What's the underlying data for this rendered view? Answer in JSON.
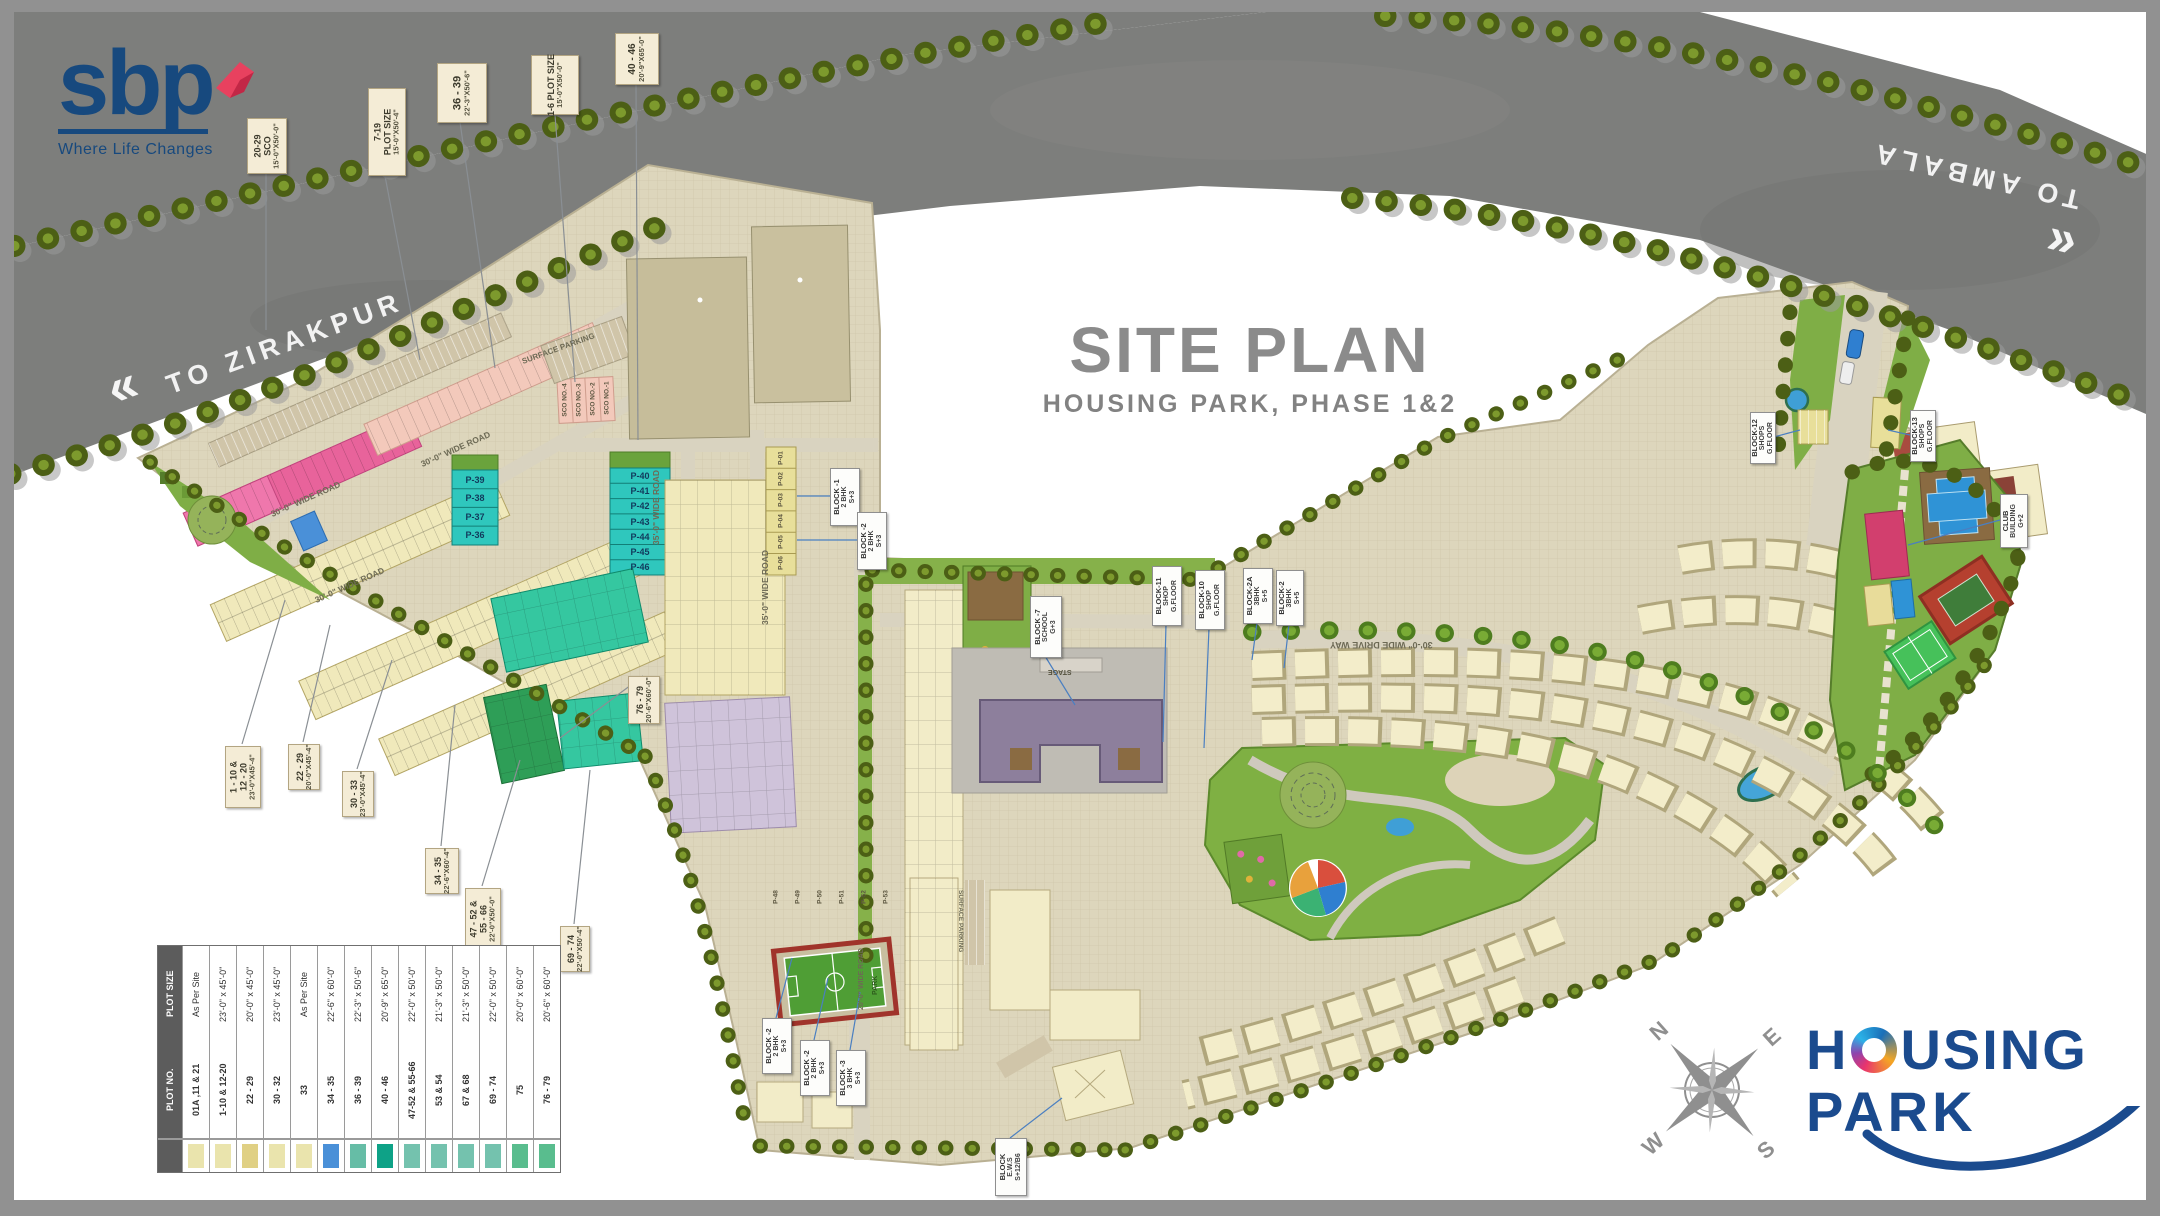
{
  "page": {
    "title": "SITE PLAN",
    "subtitle": "HOUSING PARK, PHASE 1&2"
  },
  "brand": {
    "name": "sbp",
    "tagline": "Where Life Changes"
  },
  "footer_logo": {
    "line1": "HOUSING",
    "line2": "PARK"
  },
  "compass": {
    "n": "N",
    "e": "E",
    "s": "S",
    "w": "W"
  },
  "roads": {
    "to_zirakpur": "TO ZIRAKPUR",
    "to_ambala": "TO AMBALA",
    "chevron_left": "«",
    "chevron_right": "»"
  },
  "map_labels": {
    "surface_parking": "SURFACE PARKING",
    "wide_road_30": "30'-0\" WIDE ROAD",
    "wide_road_35": "35'-0\" WIDE ROAD",
    "wide_road_20": "20'-0\" WIDE ROAD",
    "drive_way": "30'-0\" WIDE DRIVE WAY",
    "stage": "STAGE",
    "park": "PARK"
  },
  "road_callouts": [
    {
      "lines": [
        "20-29",
        "SCO",
        "15'-0\"X50'-0\""
      ]
    },
    {
      "lines": [
        "7-19",
        "PLOT SIZE",
        "15'-0\"X50'-4\""
      ]
    },
    {
      "lines": [
        "36 - 39",
        "22'-3\"X50'-6\""
      ]
    },
    {
      "lines": [
        "1-6 PLOT SIZE",
        "15'-0\"X50'-0\""
      ]
    },
    {
      "lines": [
        "40 - 46",
        "20'-9\"X65'-0\""
      ]
    }
  ],
  "edge_callouts": [
    {
      "lines": [
        "1 - 10 &",
        "12 - 20",
        "23'-0\"X45'-4\""
      ]
    },
    {
      "lines": [
        "22 - 29",
        "20'-0\"X45'-4\""
      ]
    },
    {
      "lines": [
        "30 - 33",
        "23'-0\"X45'-4\""
      ]
    },
    {
      "lines": [
        "34 - 35",
        "22'-6\"X60'-4\""
      ]
    },
    {
      "lines": [
        "47 - 52 &",
        "55 - 66",
        "22'-0\"X50'-0\""
      ]
    },
    {
      "lines": [
        "69 - 74",
        "22'-0\"X50'-4\""
      ]
    },
    {
      "lines": [
        "76 - 79",
        "20'-6\"X60'-0\""
      ]
    }
  ],
  "block_callouts": [
    {
      "lines": [
        "BLOCK -1",
        "2 BHK",
        "S+3"
      ]
    },
    {
      "lines": [
        "BLOCK -2",
        "2 BHK",
        "S+3"
      ]
    },
    {
      "lines": [
        "BLOCK -7",
        "SCHOOL",
        "G+3"
      ]
    },
    {
      "lines": [
        "BLOCK-11",
        "SHOP",
        "G.FLOOR"
      ]
    },
    {
      "lines": [
        "BLOCK-10",
        "SHOP",
        "G.FLOOR"
      ]
    },
    {
      "lines": [
        "BLOCK-2A",
        "3BHK",
        "S+5"
      ]
    },
    {
      "lines": [
        "BLOCK-2",
        "3BHK",
        "S+5"
      ]
    },
    {
      "lines": [
        "BLOCK-12",
        "SHOPS",
        "G.FLOOR"
      ]
    },
    {
      "lines": [
        "BLOCK-13",
        "SHOPS",
        "G.FLOOR"
      ]
    },
    {
      "lines": [
        "CLUB",
        "BUILDING",
        "G+2"
      ]
    },
    {
      "lines": [
        "BLOCK -2",
        "2 BHK",
        "S+3"
      ]
    },
    {
      "lines": [
        "BLOCK -2",
        "2 BHK",
        "S+3"
      ]
    },
    {
      "lines": [
        "BLOCK -3",
        "3 BHK",
        "S+3"
      ]
    },
    {
      "lines": [
        "BLOCK",
        "E.W.S",
        "S+12/B6"
      ]
    }
  ],
  "plots": {
    "teal_column_a": [
      "P-39",
      "P-38",
      "P-37",
      "P-36"
    ],
    "teal_column_b": [
      "P-40",
      "P-41",
      "P-42",
      "P-43",
      "P-44",
      "P-45",
      "P-46"
    ],
    "lavender_row": [
      "P-48",
      "P-49",
      "P-50",
      "P-51",
      "P-52",
      "P-53"
    ],
    "yellow_column": [
      "P-01",
      "P-02",
      "P-03",
      "P-04",
      "P-05",
      "P-06"
    ],
    "sco_strip": [
      "SCO NO.-4",
      "SCO NO.-3",
      "SCO NO.-2",
      "SCO NO.-1"
    ]
  },
  "legend": {
    "header_plot_no": "PLOT NO.",
    "header_plot_size": "PLOT SIZE",
    "rows": [
      {
        "no": "01A ,11 & 21",
        "size": "As Per Site",
        "color": "#eae4ad"
      },
      {
        "no": "1-10 & 12-20",
        "size": "23'-0\" x 45'-0\"",
        "color": "#eae4ad"
      },
      {
        "no": "22 - 29",
        "size": "20'-0\" x 45'-0\"",
        "color": "#e0d084"
      },
      {
        "no": "30 - 32",
        "size": "23'-0\" x 45'-0\"",
        "color": "#eae4ad"
      },
      {
        "no": "33",
        "size": "As Per Site",
        "color": "#eae4ad"
      },
      {
        "no": "34 - 35",
        "size": "22'-6\" x 60'-0\"",
        "color": "#4a90d8"
      },
      {
        "no": "36 - 39",
        "size": "22'-3\" x 50'-6\"",
        "color": "#66bda6"
      },
      {
        "no": "40 - 46",
        "size": "20'-9\" x 65'-0\"",
        "color": "#0ea287"
      },
      {
        "no": "47-52 & 55-66",
        "size": "22'-0\" x 50'-0\"",
        "color": "#74c2ae"
      },
      {
        "no": "53 & 54",
        "size": "21'-3\" x 50'-0\"",
        "color": "#74c2ae"
      },
      {
        "no": "67 & 68",
        "size": "21'-3\" x 50'-0\"",
        "color": "#74c2ae"
      },
      {
        "no": "69 - 74",
        "size": "22'-0\" x 50'-0\"",
        "color": "#74c2ae"
      },
      {
        "no": "75",
        "size": "20'-0\" x 60'-0\"",
        "color": "#59bd8e"
      },
      {
        "no": "76 - 79",
        "size": "20'-6\" x 60'-0\"",
        "color": "#59bd8e"
      }
    ]
  }
}
